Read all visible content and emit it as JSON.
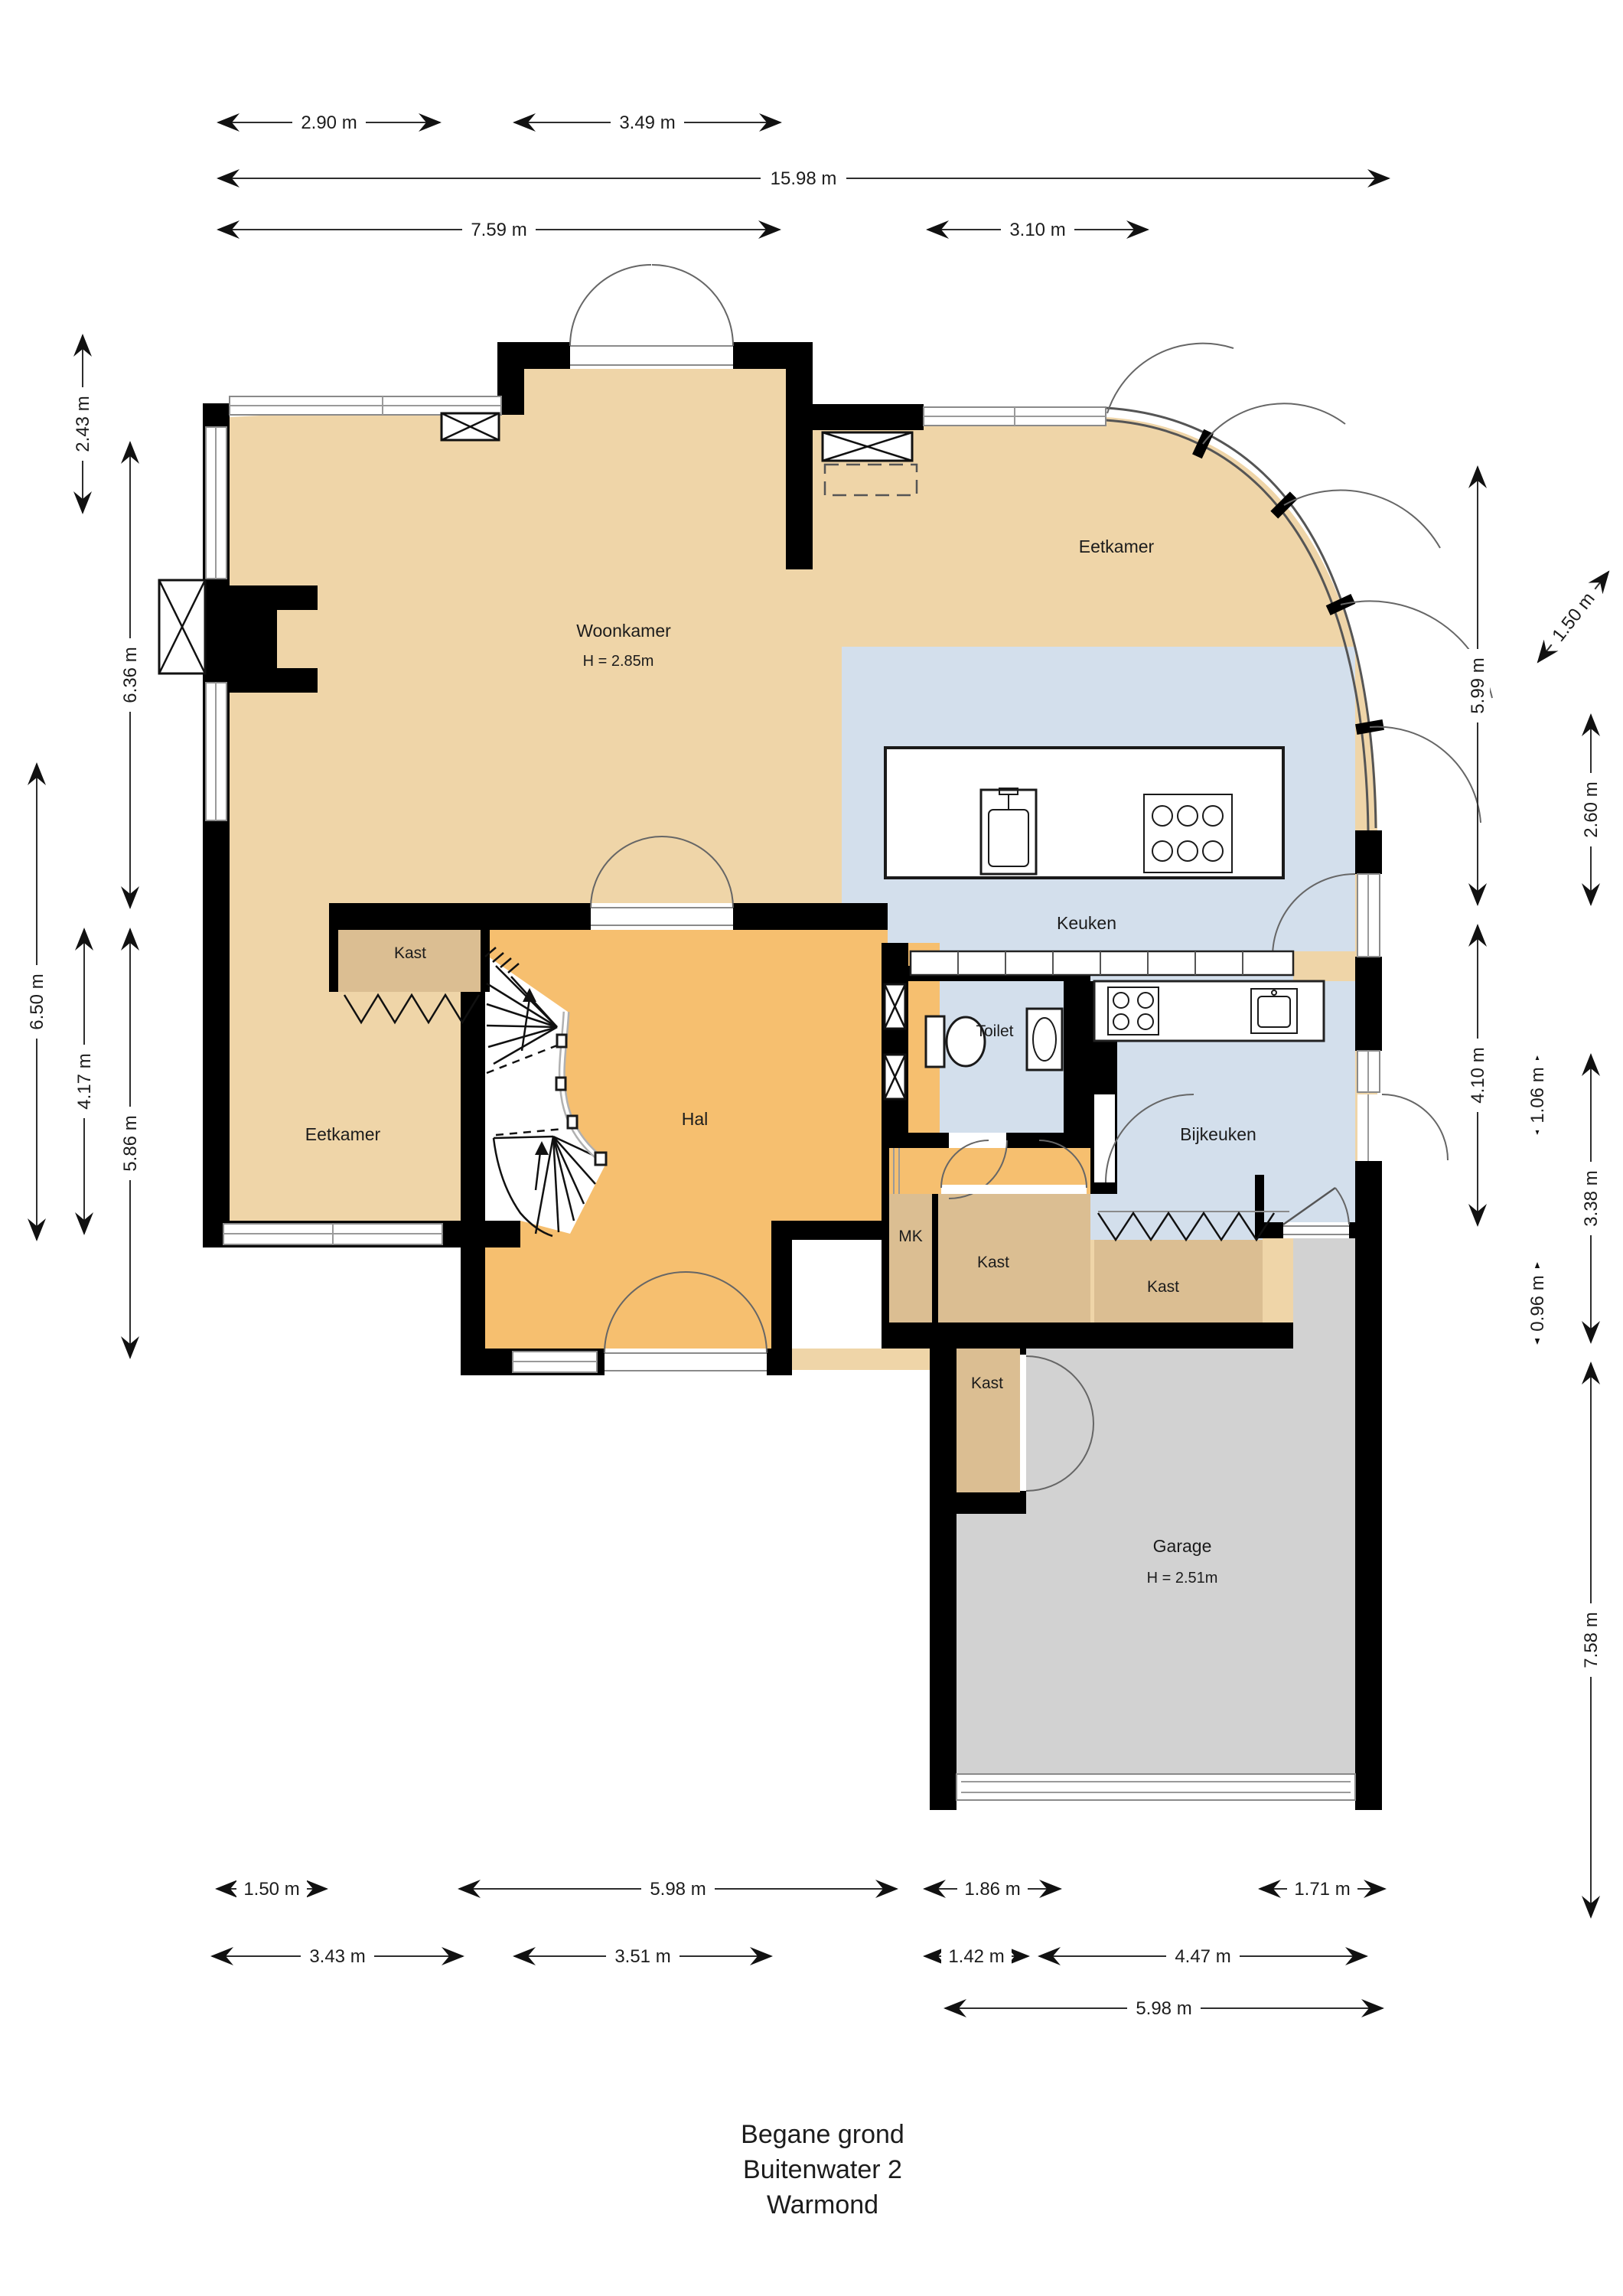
{
  "title": {
    "floor": "Begane grond",
    "address": "Buitenwater 2",
    "city": "Warmond"
  },
  "rooms": {
    "woonkamer": {
      "label": "Woonkamer",
      "ceiling_height": "H = 2.85m"
    },
    "eetkamer_top": {
      "label": "Eetkamer"
    },
    "keuken": {
      "label": "Keuken"
    },
    "toilet": {
      "label": "Toilet"
    },
    "bijkeuken": {
      "label": "Bijkeuken"
    },
    "hal": {
      "label": "Hal"
    },
    "eetkamer_left": {
      "label": "Eetkamer"
    },
    "garage": {
      "label": "Garage",
      "ceiling_height": "H = 2.51m"
    },
    "kast_stairs": {
      "label": "Kast"
    },
    "kast_hall": {
      "label": "Kast"
    },
    "kast_bijkeuken": {
      "label": "Kast"
    },
    "kast_garage": {
      "label": "Kast"
    },
    "mk": {
      "label": "MK"
    }
  },
  "dimensions": {
    "top": [
      {
        "label": "2.90 m"
      },
      {
        "label": "3.49 m"
      },
      {
        "label": "15.98 m"
      },
      {
        "label": "7.59 m"
      },
      {
        "label": "3.10 m"
      }
    ],
    "left": [
      {
        "label": "2.43 m"
      },
      {
        "label": "6.36 m"
      },
      {
        "label": "6.50 m"
      },
      {
        "label": "4.17 m"
      },
      {
        "label": "5.86 m"
      }
    ],
    "right": [
      {
        "label": "1.50 m"
      },
      {
        "label": "5.99 m"
      },
      {
        "label": "2.60 m"
      },
      {
        "label": "1.06 m"
      },
      {
        "label": "4.10 m"
      },
      {
        "label": "3.38 m"
      },
      {
        "label": "0.96 m"
      },
      {
        "label": "7.58 m"
      }
    ],
    "bottom": [
      {
        "label": "1.50 m"
      },
      {
        "label": "5.98 m"
      },
      {
        "label": "1.86 m"
      },
      {
        "label": "1.71 m"
      },
      {
        "label": "3.43 m"
      },
      {
        "label": "3.51 m"
      },
      {
        "label": "1.42 m"
      },
      {
        "label": "4.47 m"
      },
      {
        "label": "5.98 m"
      }
    ]
  },
  "colors": {
    "floor_living": "#efd5a8",
    "floor_hall": "#f6bf6f",
    "floor_kitchen": "#d3dfec",
    "floor_closet": "#dbbe92",
    "floor_garage": "#d2d2d2",
    "wall": "#000000"
  }
}
